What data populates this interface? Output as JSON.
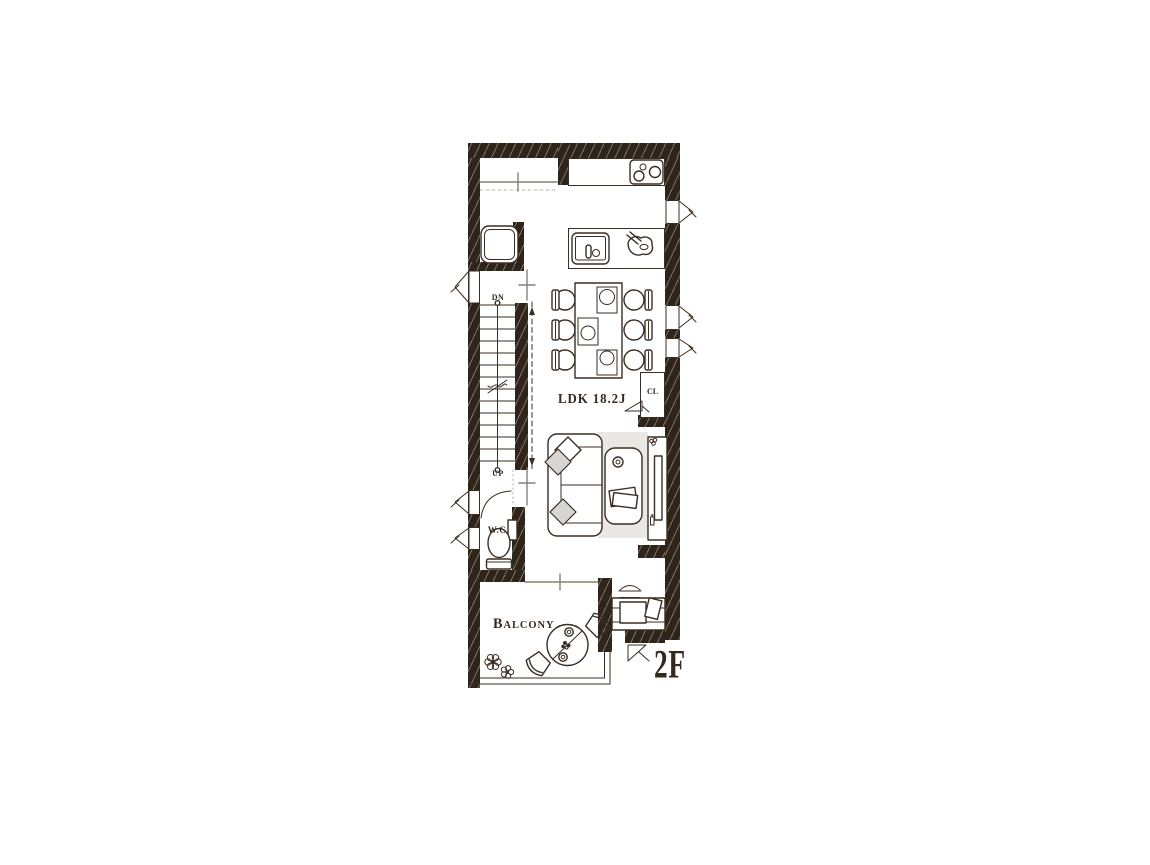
{
  "floor_plan": {
    "floor_label": "2F",
    "room_label": "LDK 18.2J",
    "balcony_label": "Balcony",
    "wc_label": "W.C",
    "closet_label": "CL",
    "stairs": {
      "down": "DN",
      "up": "UP"
    }
  },
  "colors": {
    "line": "#3a2d22",
    "wall": "#2e241a",
    "rug": "#e9e8e5",
    "cushion": "#d8d6d3",
    "text": "#33291e",
    "gray": "#8a7f73"
  }
}
